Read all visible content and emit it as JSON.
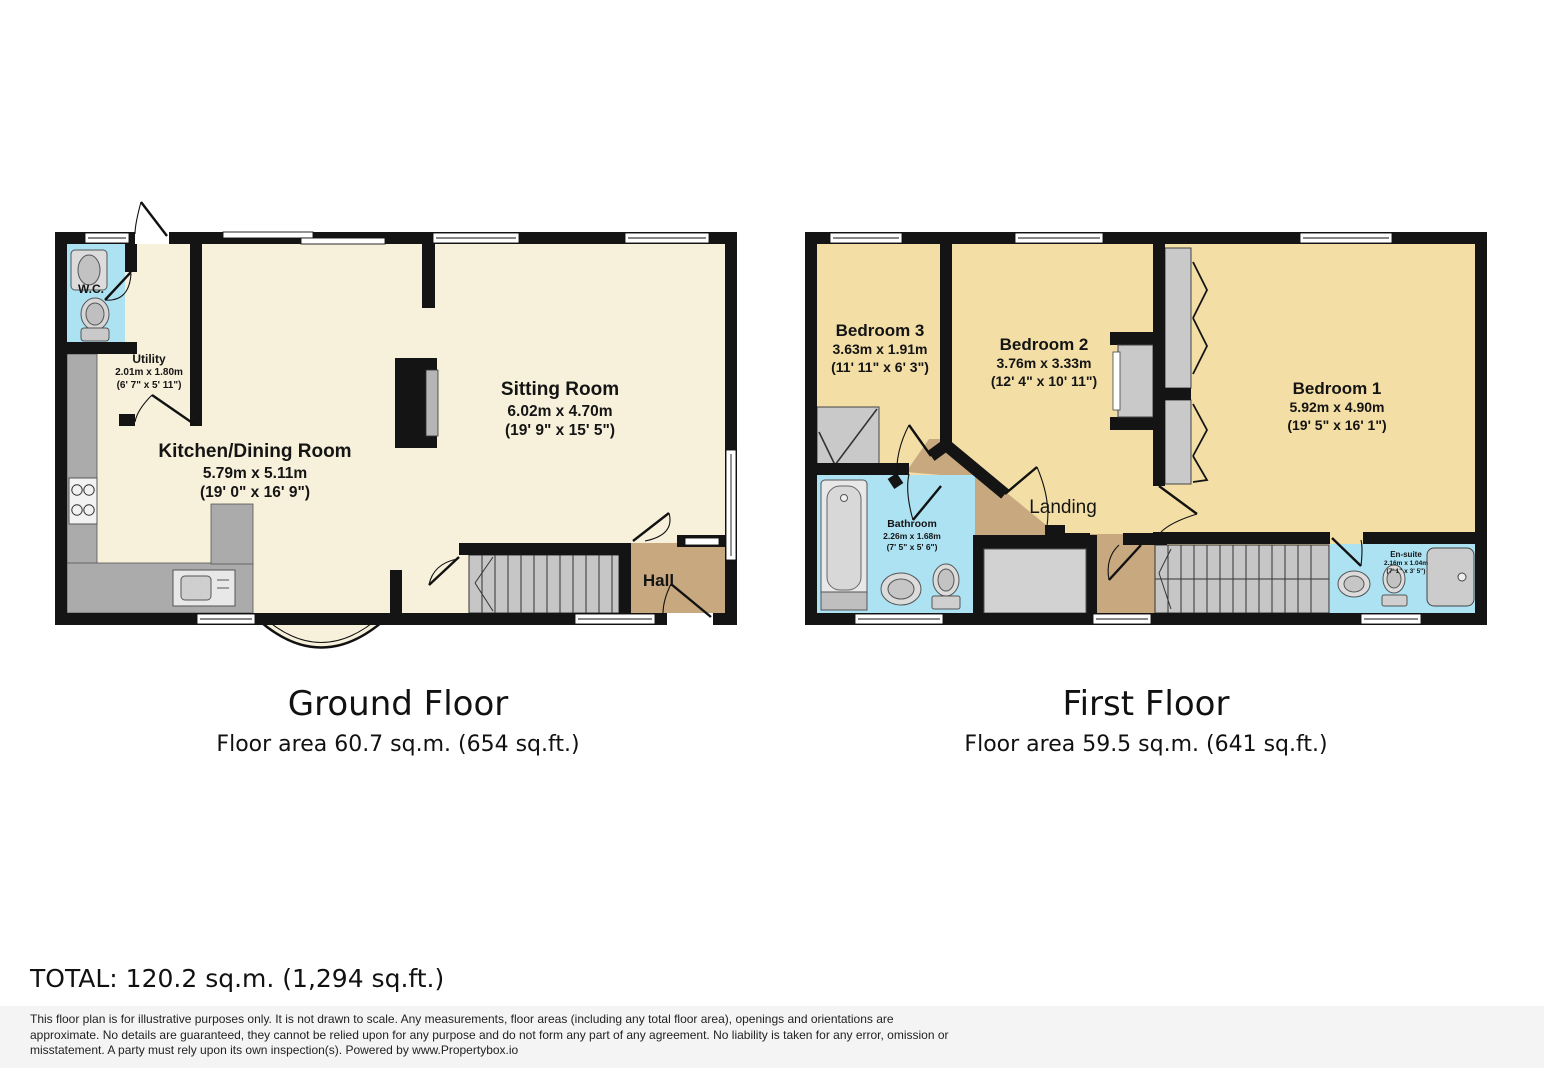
{
  "ground_floor": {
    "title": "Ground Floor",
    "area": "Floor area 60.7 sq.m. (654 sq.ft.)",
    "rooms": {
      "wc": {
        "name": "W.C."
      },
      "utility": {
        "name": "Utility",
        "metric": "2.01m x 1.80m",
        "imperial": "(6' 7\" x 5' 11\")"
      },
      "kitchen": {
        "name": "Kitchen/Dining Room",
        "metric": "5.79m x 5.11m",
        "imperial": "(19' 0\" x 16' 9\")"
      },
      "sitting": {
        "name": "Sitting Room",
        "metric": "6.02m x 4.70m",
        "imperial": "(19' 9\" x 15' 5\")"
      },
      "hall": {
        "name": "Hall"
      }
    }
  },
  "first_floor": {
    "title": "First Floor",
    "area": "Floor area 59.5 sq.m. (641 sq.ft.)",
    "rooms": {
      "bedroom3": {
        "name": "Bedroom 3",
        "metric": "3.63m x 1.91m",
        "imperial": "(11' 11\" x 6' 3\")"
      },
      "bedroom2": {
        "name": "Bedroom 2",
        "metric": "3.76m x 3.33m",
        "imperial": "(12' 4\" x 10' 11\")"
      },
      "bedroom1": {
        "name": "Bedroom 1",
        "metric": "5.92m x 4.90m",
        "imperial": "(19' 5\" x 16' 1\")"
      },
      "bathroom": {
        "name": "Bathroom",
        "metric": "2.26m x 1.68m",
        "imperial": "(7' 5\" x 5' 6\")"
      },
      "ensuite": {
        "name": "En-suite",
        "metric": "2.16m x 1.04m",
        "imperial": "(7' 1\" x 3' 5\")"
      },
      "landing": {
        "name": "Landing"
      }
    }
  },
  "total": "TOTAL: 120.2 sq.m. (1,294 sq.ft.)",
  "disclaimer": {
    "line1": "This floor plan is for illustrative purposes only. It is not drawn to scale. Any measurements, floor areas (including any total floor area), openings and orientations are",
    "line2": "approximate. No details are guaranteed, they cannot be relied upon for any purpose and do not form any part of any agreement. No liability is taken for any error, omission or",
    "line3": "misstatement. A party must rely upon its own inspection(s). Powered by www.Propertybox.io"
  },
  "colors": {
    "ground_floor_fill": "#F7F1DB",
    "bedroom_fill": "#F3DFA5",
    "wet_room_fill": "#ACE2F2",
    "hall_landing_fill": "#C8A87E",
    "wall": "#141414",
    "fixture_gray": "#ABABAB"
  }
}
